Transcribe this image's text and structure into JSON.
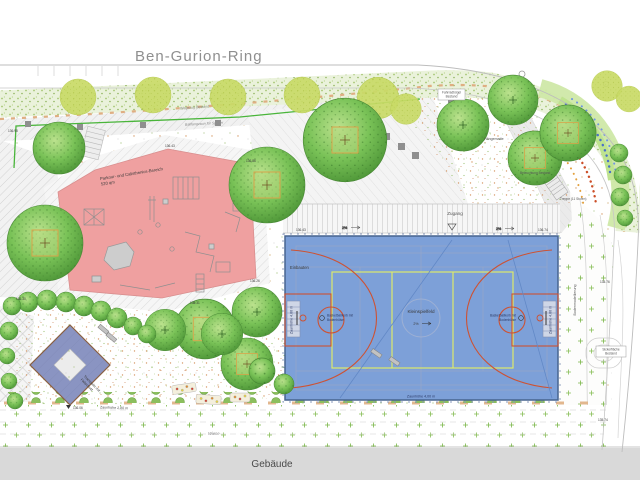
{
  "street": {
    "name": "Ben-Gurion-Ring"
  },
  "building": {
    "label": "Gebäude"
  },
  "playground": {
    "name": "Parkour- und Calisthenics-Bereich",
    "area": "520 qm"
  },
  "court": {
    "center": "Kleinspielfeld",
    "slope": "2%",
    "fence": "Zaunhöhe 4,00 m",
    "corner": "Einbauten",
    "hoop1": "Basketballkorb mit",
    "hoop2": "Bodenhülse"
  },
  "labels": {
    "zugang": "Zugang",
    "wiese": "Wiese",
    "wegezug": "Wegezug Bestand",
    "ballfang": "Ballfangzaun für Spieler",
    "fahrrad1": "Fahrradbügel",
    "fahrrad2": "Bestand",
    "haengematte": "Hängematte",
    "beleuchtung": "Beleuchtung Bestand",
    "treppe": "Treppe (11 Stufen)",
    "boden": "Bodenmodellierung",
    "sicker1": "Sickerfläche",
    "sicker2": "Bestand",
    "tramp1": "Trampolin mit",
    "tramp2": "Fallschutz",
    "zaun280": "Zaunhöhe 2,80 m",
    "slope2": "2%"
  },
  "elevations": {
    "e1": "136.98",
    "e2": "136.43",
    "e3": "136.86",
    "e4": "136.74",
    "e5": "136.26",
    "e6": "136.31",
    "e7": "136.30",
    "e8": "136.06",
    "e9": "135.76",
    "e10": "135.74",
    "e11": "136.43"
  },
  "colors": {
    "court_blue": "#7da0d8",
    "court_line_red": "#cd5233",
    "court_line_yellow": "#dde96a",
    "playground_pink": "#efa0a0",
    "trampoline_blue": "#8a94c2",
    "building_gray": "#d9d9d9",
    "hedge_green": "#e9f1da",
    "fence_green": "#49b53a",
    "tree_green": "#6db84f"
  }
}
